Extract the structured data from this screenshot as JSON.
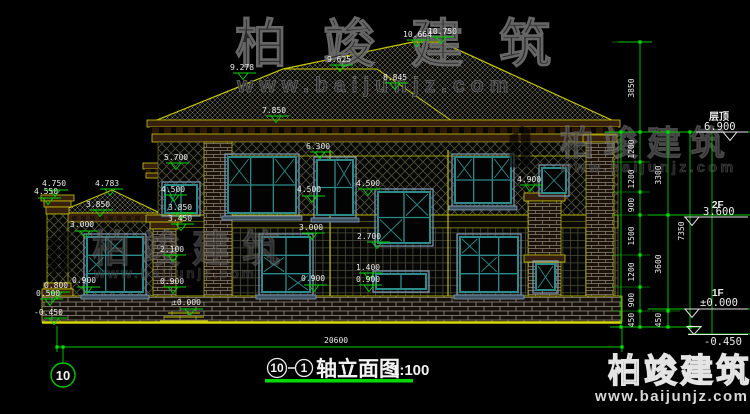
{
  "watermark": {
    "brand": "柏竣建筑",
    "site": "www.baijunjz.com"
  },
  "title": {
    "axis_start": "10",
    "axis_end": "1",
    "name": "轴立面图",
    "scale": "1:100"
  },
  "axis_bubble": "10",
  "overall_width_dim": "20600",
  "levels": [
    {
      "name": "层顶",
      "value": "6.900"
    },
    {
      "name": "2F",
      "value": "3.600"
    },
    {
      "name": "1F",
      "value": "±0.000"
    },
    {
      "name": "",
      "value": "-0.450"
    }
  ],
  "dim_chains": {
    "inner": {
      "x": 634,
      "items": [
        {
          "t": "3850",
          "y": 88
        },
        {
          "t": "1200",
          "y": 149
        },
        {
          "t": "1200",
          "y": 179
        },
        {
          "t": "900",
          "y": 205
        },
        {
          "t": "1500",
          "y": 236
        },
        {
          "t": "1200",
          "y": 272
        },
        {
          "t": "900",
          "y": 300
        },
        {
          "t": "450",
          "y": 320
        }
      ]
    },
    "mid": {
      "x": 661,
      "items": [
        {
          "t": "3300",
          "y": 175
        },
        {
          "t": "3600",
          "y": 264
        },
        {
          "t": "450",
          "y": 320
        }
      ]
    },
    "outer": {
      "x": 684,
      "items": [
        {
          "t": "7350",
          "y": 231
        }
      ]
    }
  },
  "elevation_labels": [
    {
      "t": "10.664",
      "lx": 403,
      "ly": 37,
      "mx": 417,
      "my": 40
    },
    {
      "t": "10.750",
      "lx": 428,
      "ly": 34,
      "mx": 441,
      "my": 37
    },
    {
      "t": "9.278",
      "lx": 230,
      "ly": 70,
      "mx": 243,
      "my": 73
    },
    {
      "t": "9.625",
      "lx": 327,
      "ly": 62,
      "mx": 340,
      "my": 65
    },
    {
      "t": "8.845",
      "lx": 383,
      "ly": 80,
      "mx": 395,
      "my": 83
    },
    {
      "t": "7.850",
      "lx": 262,
      "ly": 113,
      "mx": 276,
      "my": 116
    },
    {
      "t": "6.300",
      "lx": 306,
      "ly": 149,
      "mx": 320,
      "my": 152
    },
    {
      "t": "5.700",
      "lx": 164,
      "ly": 160,
      "mx": 176,
      "my": 163
    },
    {
      "t": "4.750",
      "lx": 42,
      "ly": 186,
      "mx": 55,
      "my": 190
    },
    {
      "t": "4.550",
      "lx": 34,
      "ly": 194,
      "mx": 48,
      "my": 198
    },
    {
      "t": "4.783",
      "lx": 95,
      "ly": 186,
      "mx": 110,
      "my": 189
    },
    {
      "t": "3.850",
      "lx": 86,
      "ly": 207,
      "mx": 100,
      "my": 210
    },
    {
      "t": "4.500",
      "lx": 161,
      "ly": 192,
      "mx": 174,
      "my": 195
    },
    {
      "t": "3.850",
      "lx": 168,
      "ly": 210,
      "mx": 181,
      "my": 213
    },
    {
      "t": "3.450",
      "lx": 168,
      "ly": 221,
      "mx": 181,
      "my": 224
    },
    {
      "t": "2.100",
      "lx": 160,
      "ly": 252,
      "mx": 173,
      "my": 255
    },
    {
      "t": "0.900",
      "lx": 160,
      "ly": 284,
      "mx": 173,
      "my": 287
    },
    {
      "t": "3.000",
      "lx": 70,
      "ly": 227,
      "mx": 85,
      "my": 231
    },
    {
      "t": "0.900",
      "lx": 72,
      "ly": 283,
      "mx": 87,
      "my": 287
    },
    {
      "t": "0.800",
      "lx": 44,
      "ly": 288,
      "mx": 57,
      "my": 292
    },
    {
      "t": "0.500",
      "lx": 36,
      "ly": 296,
      "mx": 50,
      "my": 299
    },
    {
      "t": "-0.450",
      "lx": 34,
      "ly": 315,
      "mx": 54,
      "my": 318
    },
    {
      "t": "±0.000",
      "lx": 172,
      "ly": 305,
      "mx": 190,
      "my": 309
    },
    {
      "t": "3.000",
      "lx": 299,
      "ly": 230,
      "mx": 312,
      "my": 233
    },
    {
      "t": "0.900",
      "lx": 301,
      "ly": 281,
      "mx": 314,
      "my": 285
    },
    {
      "t": "4.500",
      "lx": 297,
      "ly": 192,
      "mx": 312,
      "my": 196
    },
    {
      "t": "4.500",
      "lx": 356,
      "ly": 186,
      "mx": 368,
      "my": 189
    },
    {
      "t": "2.700",
      "lx": 357,
      "ly": 239,
      "mx": 377,
      "my": 242
    },
    {
      "t": "1.400",
      "lx": 356,
      "ly": 270,
      "mx": 369,
      "my": 273
    },
    {
      "t": "0.900",
      "lx": 356,
      "ly": 282,
      "mx": 369,
      "my": 285
    },
    {
      "t": "4.900",
      "lx": 517,
      "ly": 182,
      "mx": 530,
      "my": 185
    }
  ]
}
